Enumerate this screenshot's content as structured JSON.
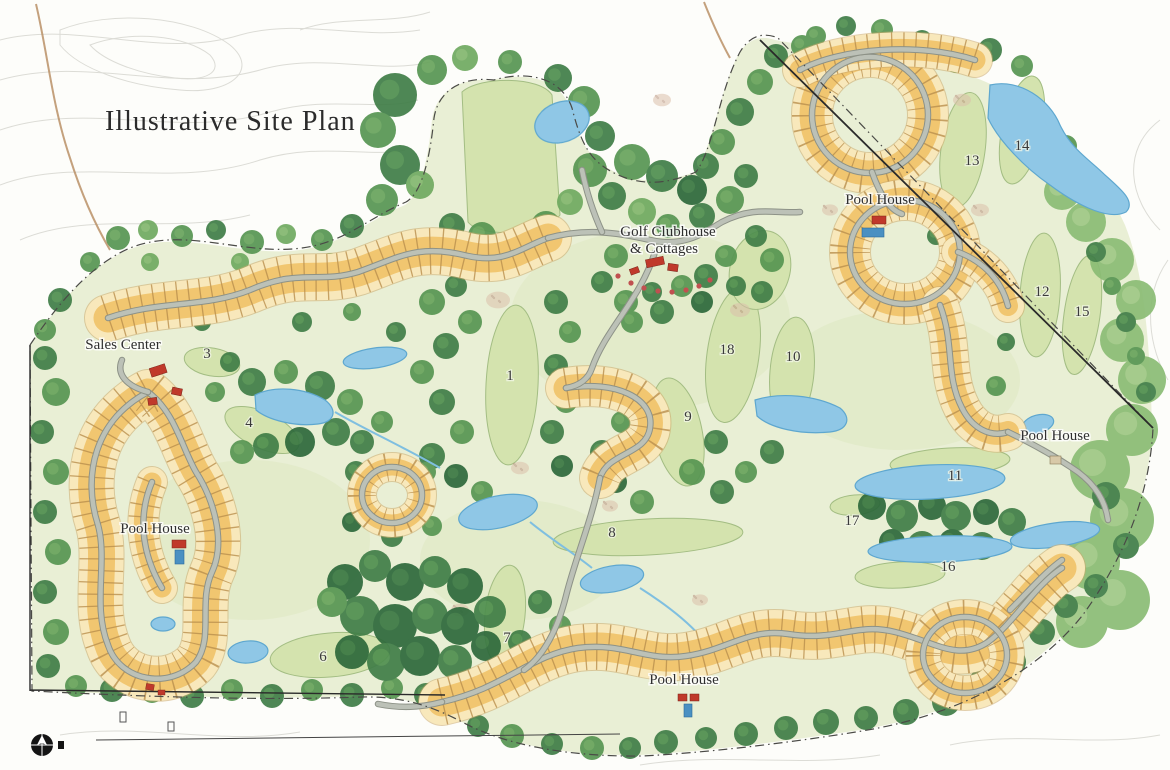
{
  "title": "Illustrative Site Plan",
  "labels": {
    "clubhouse_line1": "Golf Clubhouse",
    "clubhouse_line2": "&  Cottages",
    "pool_house_ne": "Pool House",
    "pool_house_east": "Pool House",
    "pool_house_west": "Pool House",
    "pool_house_south": "Pool House",
    "sales_center": "Sales Center"
  },
  "hole_numbers": {
    "h1": "1",
    "h3": "3",
    "h4": "4",
    "h6": "6",
    "h7": "7",
    "h8": "8",
    "h9": "9",
    "h10": "10",
    "h11": "11",
    "h12": "12",
    "h13": "13",
    "h14": "14",
    "h15": "15",
    "h16": "16",
    "h17": "17",
    "h18": "18"
  },
  "colors": {
    "background": "#fdfdfa",
    "lot_yellow": "#f1c670",
    "lot_pale": "#f8e8bb",
    "road_gray": "#bcc1b7",
    "fairway_green": "#d4e3ae",
    "forest_green": "#3f7d46",
    "water_blue": "#8fc7e6",
    "building_red": "#c0392b"
  }
}
